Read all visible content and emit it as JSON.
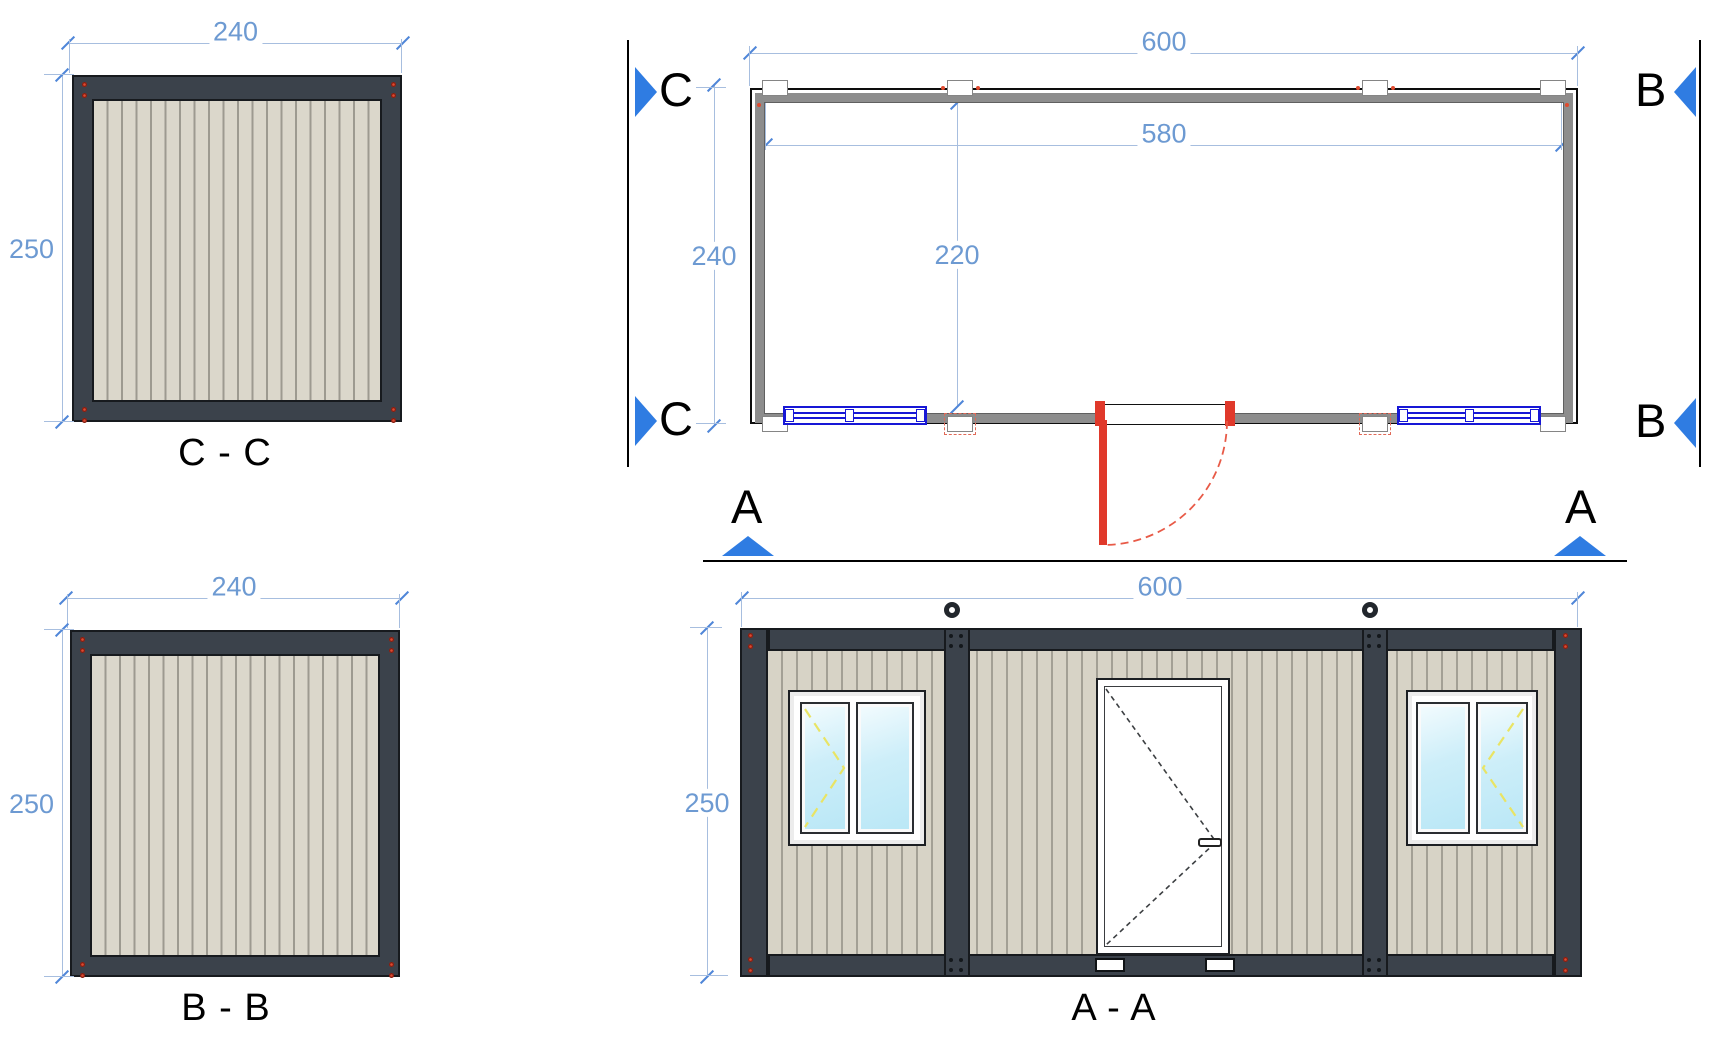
{
  "views": {
    "cc": {
      "label": "C - C",
      "width_dim": "240",
      "height_dim": "250"
    },
    "bb": {
      "label": "B - B",
      "width_dim": "240",
      "height_dim": "250"
    },
    "plan": {
      "overall_width_dim": "600",
      "inner_width_dim": "580",
      "overall_depth_dim": "240",
      "inner_depth_dim": "220"
    },
    "aa": {
      "label": "A - A",
      "width_dim": "600",
      "height_dim": "250"
    }
  },
  "section_markers": {
    "a": "A",
    "b": "B",
    "c": "C"
  },
  "palette": {
    "dimension_blue": "#6d9ad2",
    "marker_blue": "#2f7ce2",
    "frame_dark": "#3b424b",
    "siding_beige": "#d7d3c6",
    "wall_gray": "#8d8d8d",
    "door_red": "#e0392b",
    "plan_window_blue": "#1717d6",
    "glass_blue": "#cdeef9",
    "opening_symbol_yellow": "#e9e464"
  }
}
